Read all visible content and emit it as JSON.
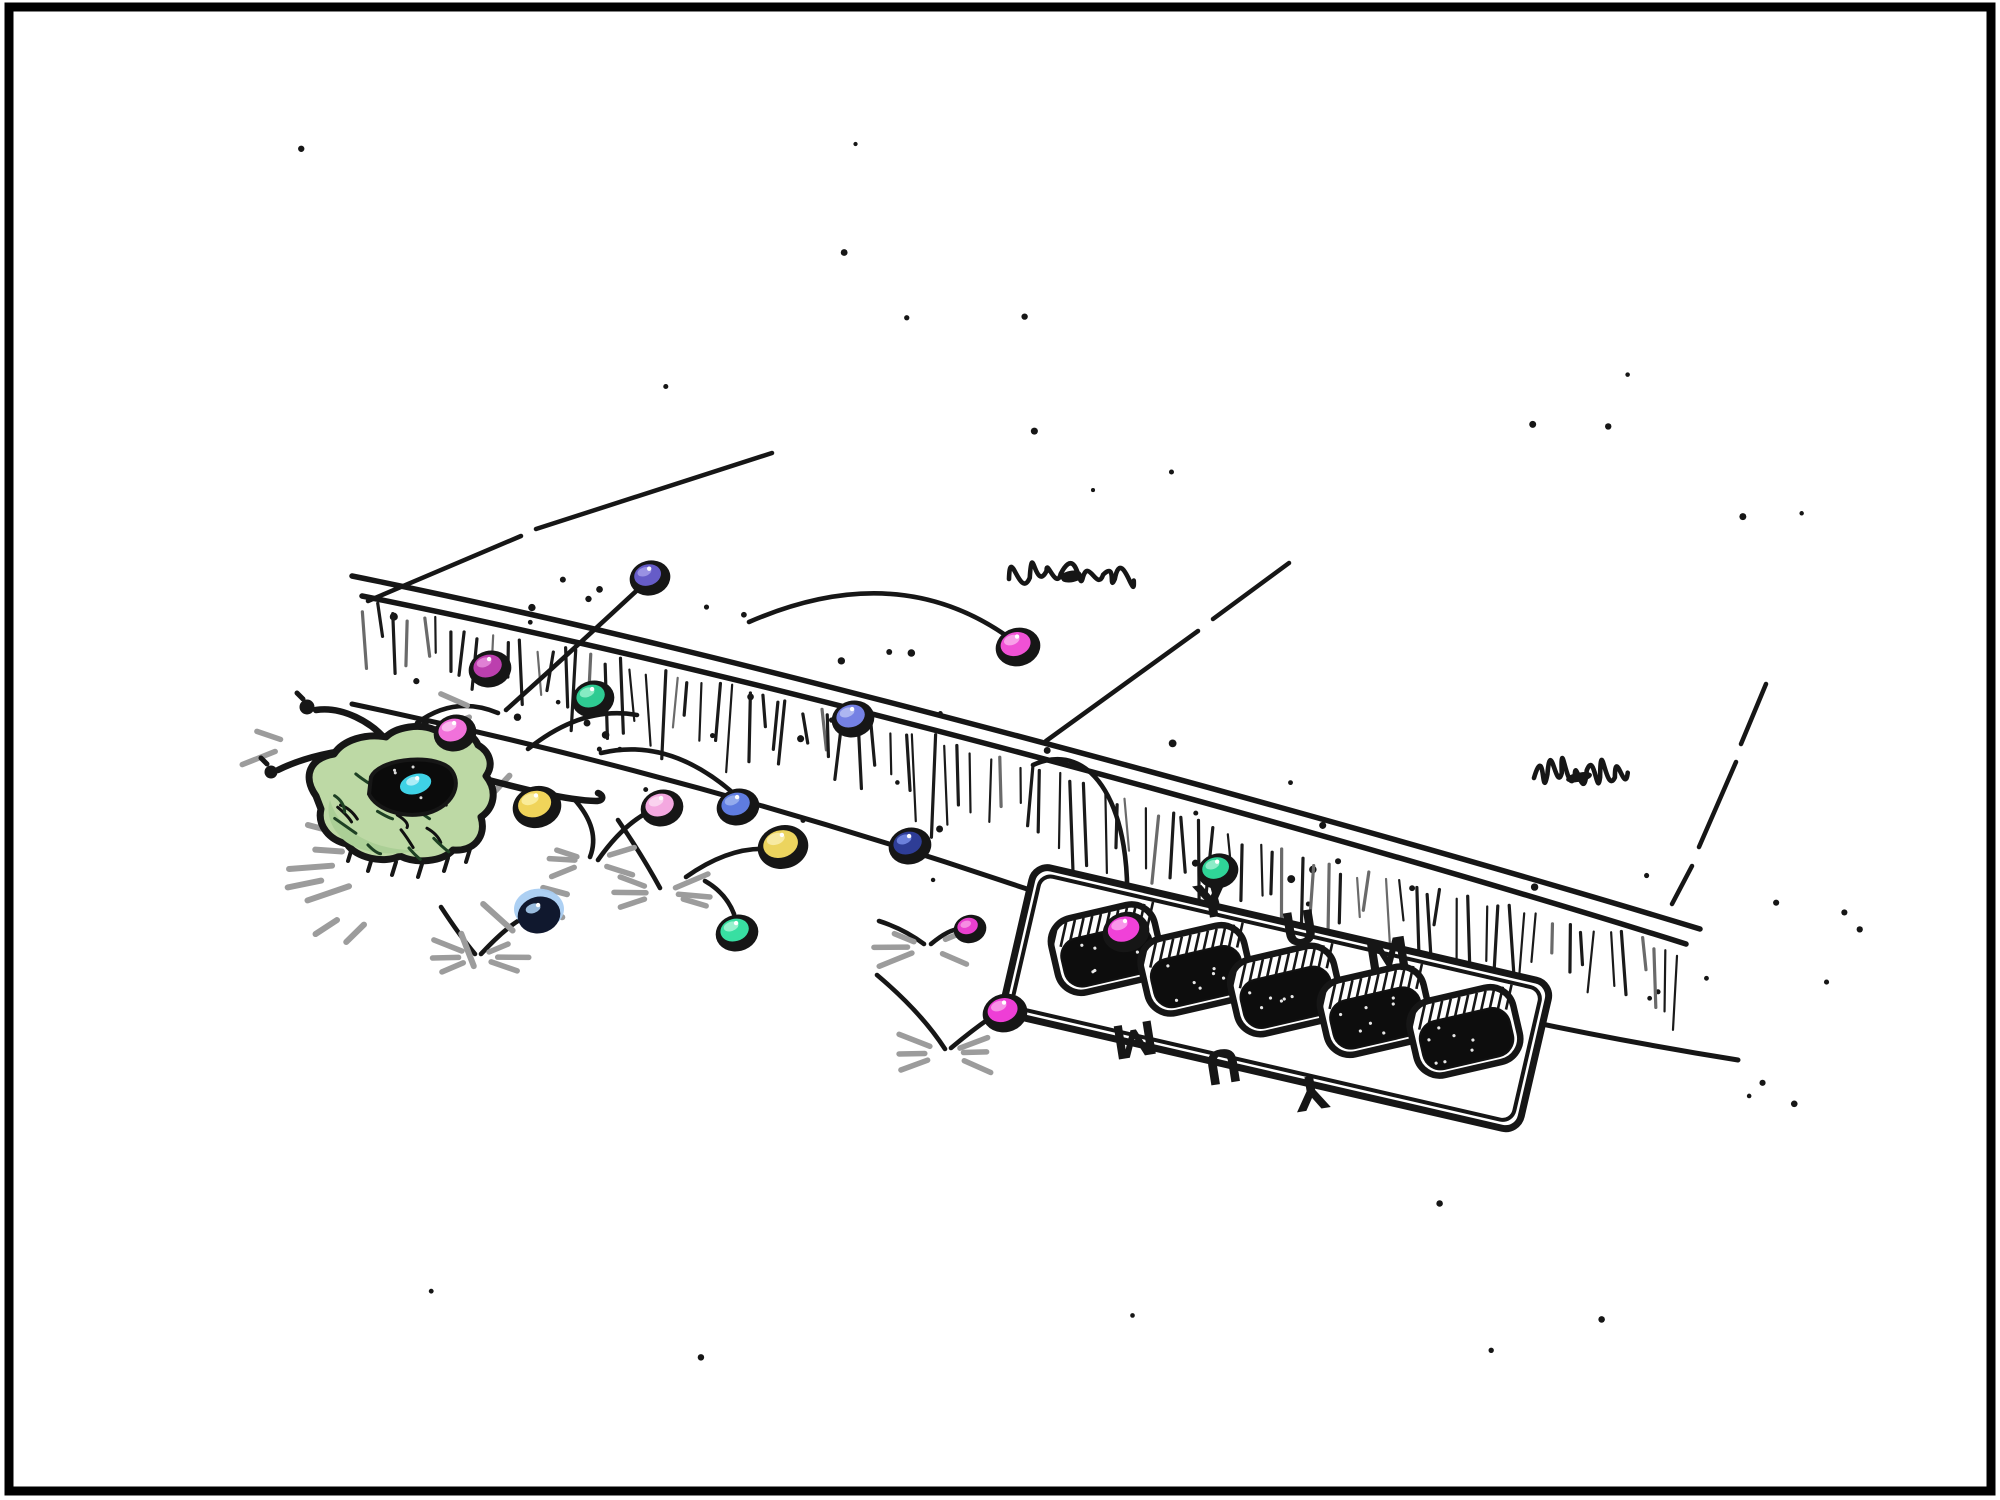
{
  "canvas": {
    "width": 2000,
    "height": 1500,
    "background": "#ffffff"
  },
  "frame": {
    "color": "#000000",
    "stroke_width": 9,
    "inset": 9
  },
  "palette": {
    "ink": "#161616",
    "splash_gray": "#9c9c9c",
    "hatch_gray": "#6a6a6a"
  },
  "sidewalk": {
    "joints": [
      "M368,601 L521,536 M536,529 L772,453",
      "M1046,741 L1198,631 M1213,619 L1289,563",
      "M1766,684 L1741,744 M1736,762 L1699,847 M1692,866 L1672,904"
    ],
    "curb": {
      "lip_top": "M352,576 C560,618 760,668 980,726 C1200,784 1480,862 1700,929",
      "lip_bottom": "M362,596 C560,636 760,684 980,742 C1200,800 1470,876 1686,944",
      "band_bottom": "M352,704 C560,748 780,806 1000,880 C1220,954 1500,1022 1738,1060",
      "guide_top": [
        [
          362,
          596
        ],
        [
          700,
          672
        ],
        [
          1000,
          748
        ],
        [
          1300,
          852
        ],
        [
          1690,
          944
        ]
      ],
      "guide_bottom": [
        [
          352,
          704
        ],
        [
          700,
          788
        ],
        [
          1000,
          880
        ],
        [
          1300,
          985
        ],
        [
          1730,
          1058
        ]
      ],
      "hatch_count": 94,
      "band_dot_count": 62
    },
    "sparse_dots_top": 14,
    "sparse_dots_bottom": 6,
    "scribbles": [
      {
        "cx": 1073,
        "cy": 576,
        "w": 128,
        "h": 30
      },
      {
        "cx": 1580,
        "cy": 775,
        "w": 92,
        "h": 36
      }
    ]
  },
  "trajectories": [
    "M417,723 Q455,695 498,713",
    "M506,710 Q575,648 646,582",
    "M528,749 Q583,705 637,715",
    "M601,753 Q668,737 732,792",
    "M574,799 Q601,829 590,857",
    "M598,860 Q626,820 657,808",
    "M618,820 Q642,855 660,888",
    "M686,877 Q734,843 777,850",
    "M705,881 Q726,893 734,914",
    "M749,622 Q901,556 1015,642",
    "M879,921 Q904,929 924,944",
    "M931,944 Q949,929 960,929",
    "M877,975 Q921,1012 945,1049",
    "M951,1048 Q976,1027 996,1014",
    "M1033,765 C1092,738 1135,808 1126,922",
    "M441,907 Q460,936 475,954",
    "M481,954 Q506,927 523,918",
    "M1213,888 L1217,903"
  ],
  "splashes": [
    [
      477,
      957,
      6
    ],
    [
      590,
      861,
      5
    ],
    [
      663,
      893,
      6
    ],
    [
      927,
      947,
      5
    ],
    [
      947,
      1053,
      6
    ],
    [
      294,
      744,
      2
    ],
    [
      482,
      712,
      2
    ]
  ],
  "pouch": {
    "fill": "#bdd9a5",
    "shade_fill": "#abcf96",
    "opening_fill": "#0b0b0b",
    "body": "M316,796 C302,776 310,758 334,754 C343,740 366,733 386,737 C396,727 420,723 435,730 C452,724 472,731 478,745 C490,752 494,765 486,776 C498,791 494,808 481,817 C487,837 473,852 453,850 C442,862 416,864 400,856 C384,864 356,858 347,844 C329,840 317,825 321,809 Z",
    "shade": "M330,800 C340,835 380,852 420,850 C390,858 352,852 340,836 C330,826 326,812 330,800 Z",
    "opening": "M371,777 C380,757 440,753 452,771 C462,786 452,806 428,813 C402,819 376,809 369,794 Z",
    "cords": [
      "M388,742 C372,722 342,706 316,710",
      "M370,750 C340,748 302,758 278,770",
      "M450,770 C498,782 558,800 596,801 C604,801 604,795 598,793"
    ],
    "knots": [
      [
        307,
        707,
        7.5
      ],
      [
        271,
        772,
        6.5
      ]
    ],
    "halo_center": [
      432,
      858
    ],
    "fringe": [
      [
        352,
        848
      ],
      [
        372,
        858
      ],
      [
        396,
        862
      ],
      [
        422,
        864
      ],
      [
        448,
        858
      ],
      [
        470,
        849
      ]
    ]
  },
  "beads": [
    [
      455,
      733,
      18,
      "#f171da",
      "#fcc0ef",
      "std"
    ],
    [
      537,
      807,
      21,
      "#f0d45a",
      "#fbeea0",
      "std"
    ],
    [
      650,
      578,
      17,
      "#665cc8",
      "#9f97e6",
      "std"
    ],
    [
      490,
      669,
      18,
      "#bc3fae",
      "#e387d8",
      "std"
    ],
    [
      593,
      699,
      18,
      "#2ecb92",
      "#90efc9",
      "std"
    ],
    [
      1018,
      647,
      19,
      "#f051d5",
      "#f9a8eb",
      "std"
    ],
    [
      853,
      719,
      18,
      "#7581e4",
      "#b4bbf2",
      "std"
    ],
    [
      910,
      846,
      18,
      "#2e3d96",
      "#7287e2",
      "std"
    ],
    [
      662,
      808,
      18,
      "#f4a8e0",
      "#fbd6f1",
      "std"
    ],
    [
      738,
      807,
      18,
      "#5f7ce0",
      "#9ab0ee",
      "std"
    ],
    [
      783,
      847,
      22,
      "#ecd45e",
      "#f8ecaa",
      "std"
    ],
    [
      539,
      915,
      18,
      "#18223e",
      "#a9cef2",
      "halo"
    ],
    [
      737,
      933,
      18,
      "#38dfa2",
      "#a2f4d4",
      "std"
    ],
    [
      970,
      929,
      13,
      "#e93fce",
      "#f795e4",
      "std"
    ],
    [
      1005,
      1013,
      19,
      "#ee3ed6",
      "#f79ae8",
      "std"
    ],
    [
      1126,
      932,
      20,
      "#f041d8",
      "#f9a0ec",
      "std"
    ],
    [
      1218,
      871,
      17,
      "#2fd598",
      "#97f0cd",
      "std"
    ],
    [
      418,
      787,
      16,
      "#3fd2e6",
      "#b8f0f8",
      "open"
    ]
  ],
  "grate": {
    "origin": [
      1048,
      890
    ],
    "angle": 13,
    "frame_outer": {
      "x": -18,
      "y": -22,
      "w": 530,
      "h": 152,
      "rx": 16
    },
    "frame_inner": {
      "x": -10,
      "y": -14,
      "w": 514,
      "h": 136,
      "rx": 12
    },
    "slots": {
      "count": 5,
      "cx0": 70,
      "step": 92,
      "cy": 44,
      "w": 106,
      "h": 76,
      "rx": 24,
      "tilt": -26
    },
    "letters_top": [
      "Y",
      "U",
      "M"
    ],
    "letters_bottom": [
      "M",
      "U",
      "Y"
    ],
    "letter_pos_top": [
      [
        162,
        -26
      ],
      [
        254,
        -19
      ],
      [
        346,
        -12
      ]
    ],
    "letter_pos_bottom": [
      [
        118,
        126
      ],
      [
        210,
        132
      ],
      [
        302,
        138
      ]
    ],
    "rot_top": -22,
    "rot_bottom": 158,
    "letter_size": 46
  }
}
